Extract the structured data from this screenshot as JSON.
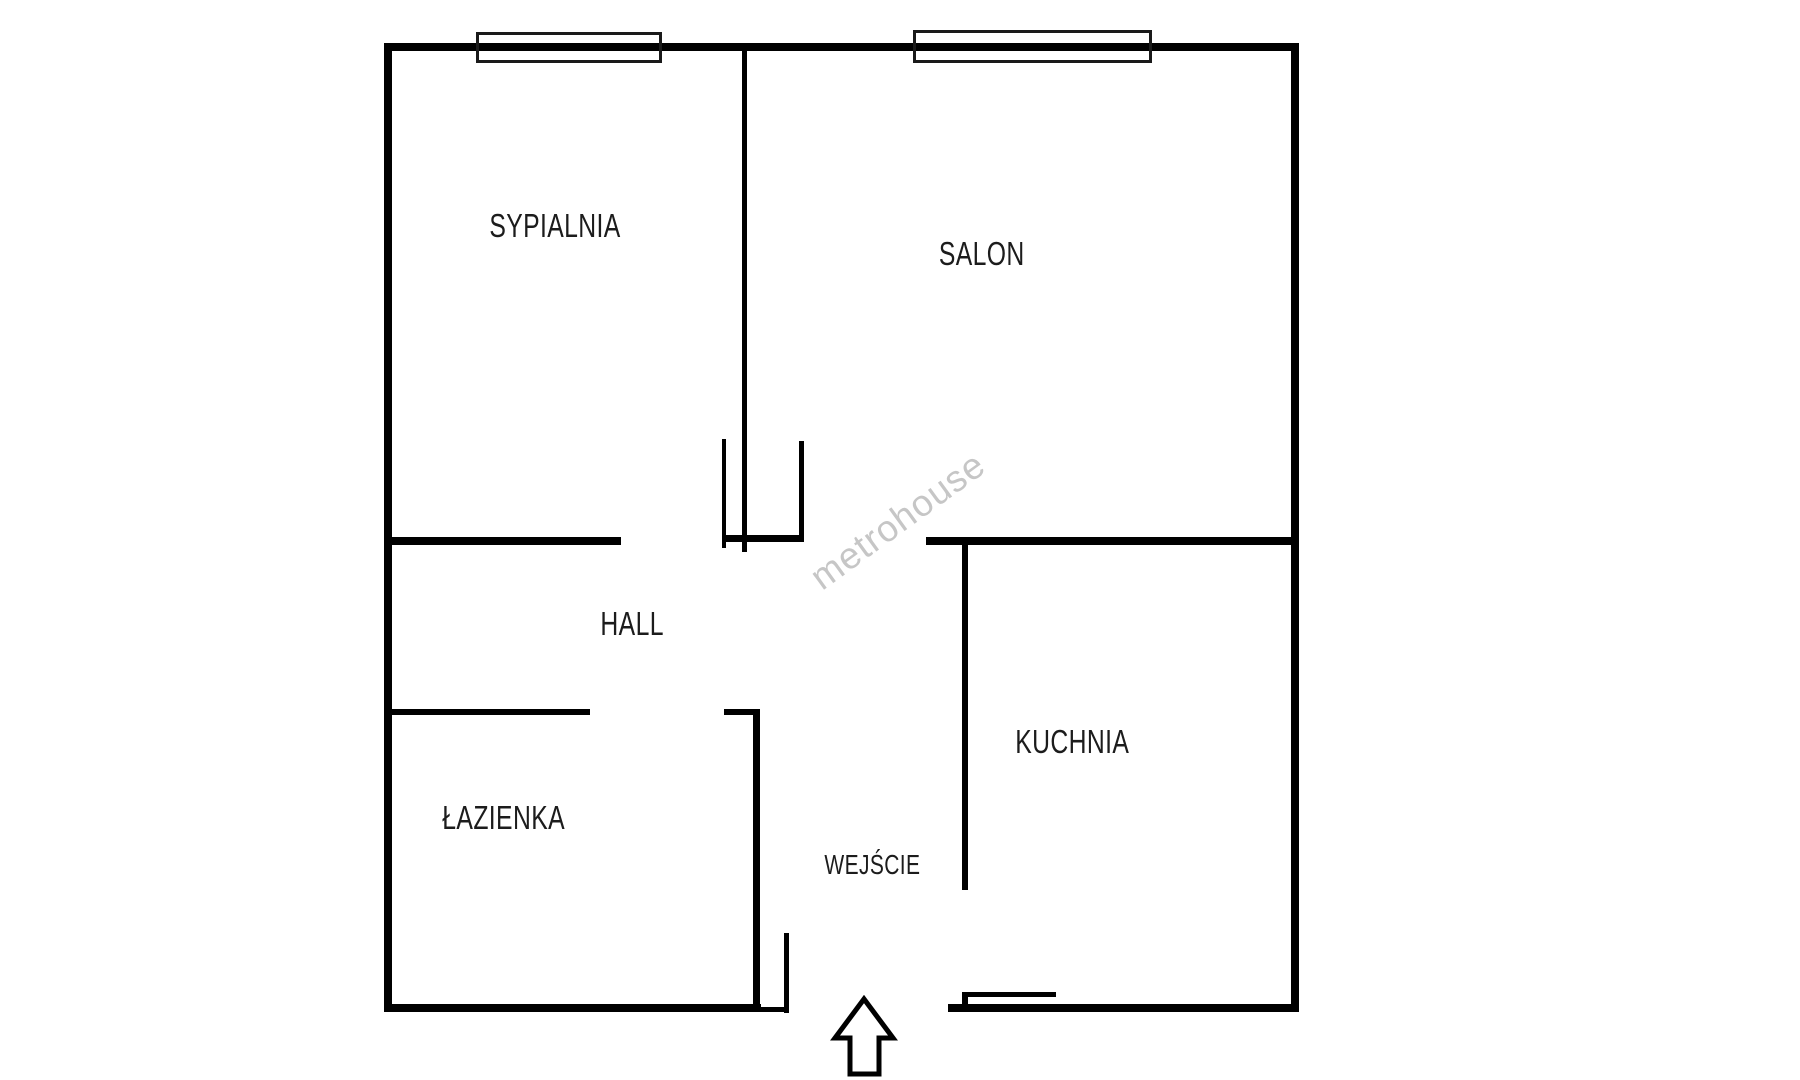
{
  "title": "Floor plan",
  "rooms": [
    {
      "id": "sypialnia",
      "label": "SYPIALNIA"
    },
    {
      "id": "salon",
      "label": "SALON"
    },
    {
      "id": "hall",
      "label": "HALL"
    },
    {
      "id": "lazienka",
      "label": "ŁAZIENKA"
    },
    {
      "id": "kuchnia",
      "label": "KUCHNIA"
    }
  ],
  "entrance": {
    "label": "WEJŚCIE",
    "arrow_icon": "up-arrow"
  },
  "watermark": {
    "text": "metrohouse",
    "color": "#c6c6c6"
  },
  "plan": {
    "background": "#ffffff",
    "wall_color": "#000000",
    "window_border_color": "#1a1a1a",
    "walls": [
      {
        "name": "outer-wall-top",
        "x": 384,
        "y": 43,
        "w": 915,
        "h": 8
      },
      {
        "name": "outer-wall-left",
        "x": 384,
        "y": 43,
        "w": 8,
        "h": 969
      },
      {
        "name": "outer-wall-right",
        "x": 1291,
        "y": 43,
        "w": 8,
        "h": 969
      },
      {
        "name": "outer-wall-bottom-left",
        "x": 384,
        "y": 1004,
        "w": 377,
        "h": 8
      },
      {
        "name": "outer-wall-bottom-right",
        "x": 948,
        "y": 1004,
        "w": 351,
        "h": 8
      },
      {
        "name": "bedroom-salon-divider",
        "x": 742,
        "y": 51,
        "w": 5,
        "h": 501
      },
      {
        "name": "bedroom-hall-wall",
        "x": 391,
        "y": 537,
        "w": 230,
        "h": 8
      },
      {
        "name": "door-jamb-left",
        "x": 722,
        "y": 439,
        "w": 4,
        "h": 109
      },
      {
        "name": "door-jamb-right",
        "x": 799,
        "y": 441,
        "w": 5,
        "h": 101
      },
      {
        "name": "door-sill",
        "x": 722,
        "y": 535,
        "w": 82,
        "h": 7
      },
      {
        "name": "salon-kitchen-wall",
        "x": 926,
        "y": 537,
        "w": 365,
        "h": 8
      },
      {
        "name": "kitchen-left-wall",
        "x": 962,
        "y": 545,
        "w": 6,
        "h": 345
      },
      {
        "name": "bathroom-top-wall",
        "x": 391,
        "y": 709,
        "w": 199,
        "h": 6
      },
      {
        "name": "bathroom-top-wall-right",
        "x": 724,
        "y": 709,
        "w": 34,
        "h": 6
      },
      {
        "name": "bathroom-right-wall",
        "x": 753,
        "y": 709,
        "w": 7,
        "h": 303
      },
      {
        "name": "entrance-jamb",
        "x": 784,
        "y": 933,
        "w": 5,
        "h": 80
      },
      {
        "name": "entrance-jamb-foot",
        "x": 760,
        "y": 1007,
        "w": 29,
        "h": 5
      },
      {
        "name": "kitchen-entry-tick",
        "x": 962,
        "y": 992,
        "w": 94,
        "h": 5
      },
      {
        "name": "kitchen-entry-tick-post",
        "x": 962,
        "y": 992,
        "w": 6,
        "h": 12
      }
    ],
    "windows": [
      {
        "name": "window-bedroom",
        "x": 476,
        "y": 32,
        "w": 186,
        "h": 31
      },
      {
        "name": "window-salon",
        "x": 913,
        "y": 30,
        "w": 239,
        "h": 33
      }
    ]
  }
}
